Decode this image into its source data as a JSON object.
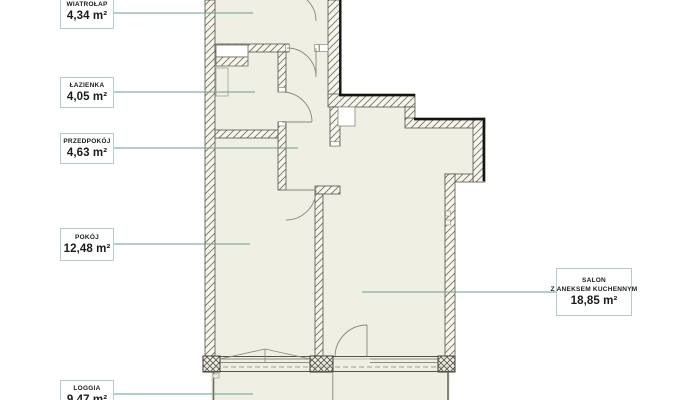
{
  "page": {
    "type": "apartment-floor-plan"
  },
  "colors": {
    "room_fill": "#f0efe4",
    "wall_outline": "#55524a",
    "leader_line": "#67a191",
    "label_border": "#b5cdc2",
    "text": "#1b1b18"
  },
  "rooms": [
    {
      "key": "wiatrolap",
      "name": "WIATROŁAP",
      "area": "4,34 m²"
    },
    {
      "key": "lazienka",
      "name": "ŁAZIENKA",
      "area": "4,05 m²"
    },
    {
      "key": "przedpokoj",
      "name": "PRZEDPOKÓJ",
      "area": "4,63 m²"
    },
    {
      "key": "pokoj",
      "name": "POKÓJ",
      "area": "12,48 m²"
    },
    {
      "key": "salon",
      "name": "SALON",
      "name_line2": "Z ANEKSEM KUCHENNYM",
      "area": "18,85 m²"
    },
    {
      "key": "loggia",
      "name": "LOGGIA",
      "area": "9,47 m²"
    }
  ]
}
